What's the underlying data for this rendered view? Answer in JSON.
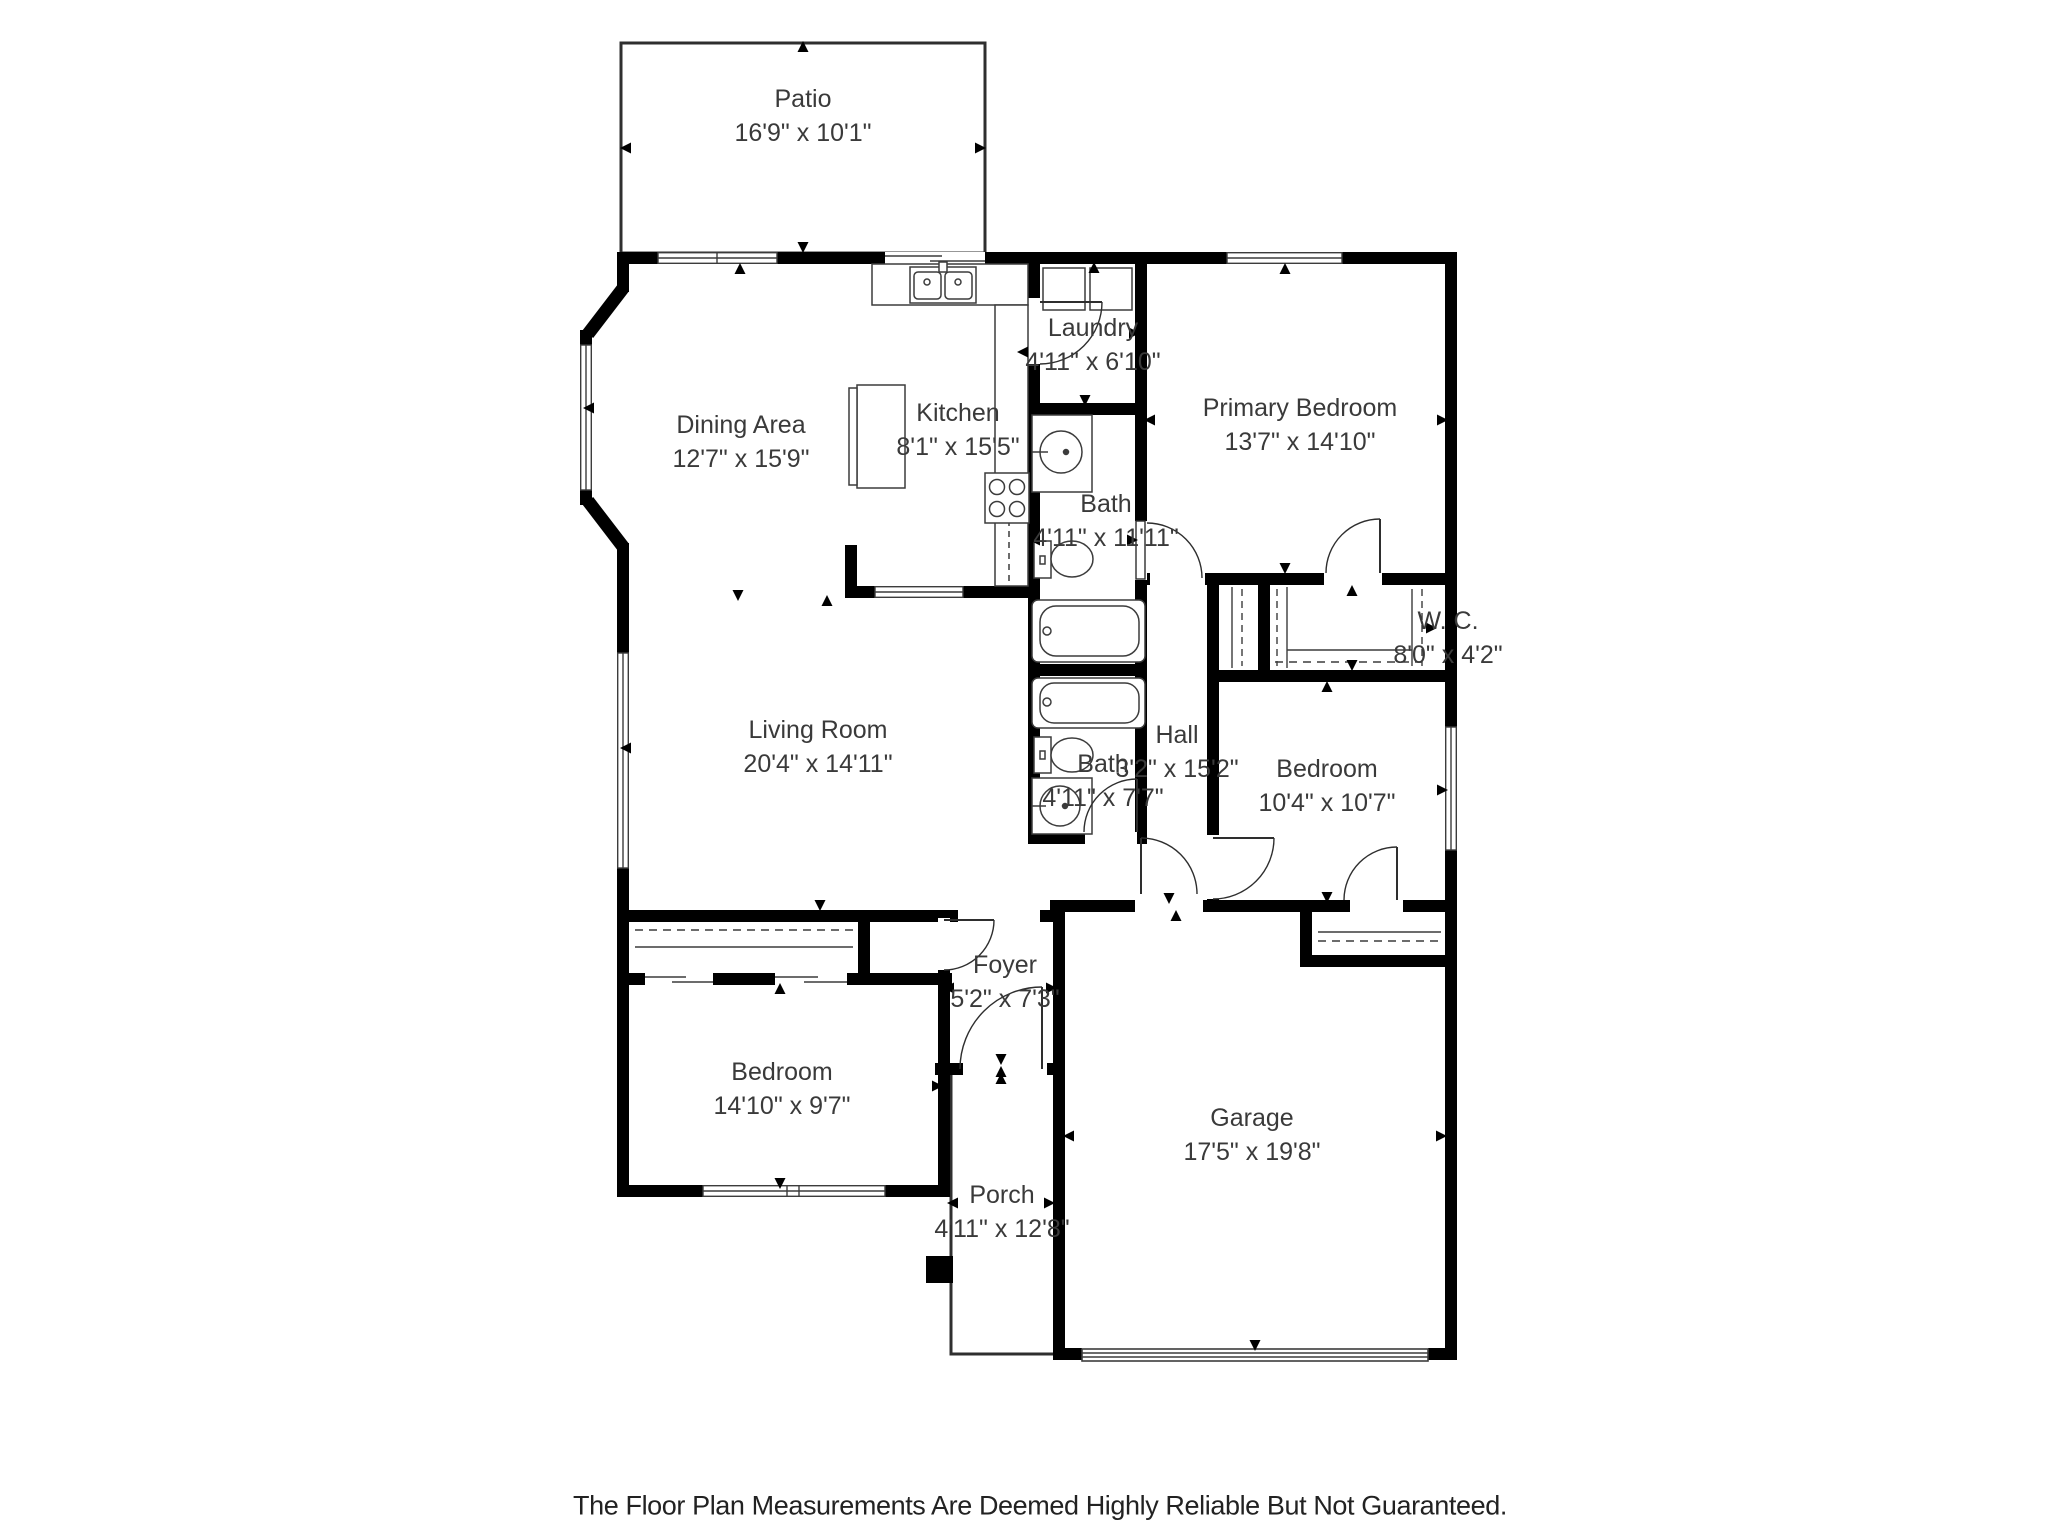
{
  "colors": {
    "wall": "#000000",
    "label_text": "#3a3a3a",
    "thin_line": "#3c3c3c",
    "background": "#ffffff",
    "footer_text": "#222222"
  },
  "rooms": [
    {
      "id": "patio",
      "name": "Patio",
      "dims": "16'9\" x 10'1\""
    },
    {
      "id": "laundry",
      "name": "Laundry",
      "dims": "4'11\" x 6'10\""
    },
    {
      "id": "dining-area",
      "name": "Dining Area",
      "dims": "12'7\" x 15'9\""
    },
    {
      "id": "kitchen",
      "name": "Kitchen",
      "dims": "8'1\" x 15'5\""
    },
    {
      "id": "primary-bedroom",
      "name": "Primary Bedroom",
      "dims": "13'7\" x 14'10\""
    },
    {
      "id": "bath-upper",
      "name": "Bath",
      "dims": "4'11\" x 11'11\""
    },
    {
      "id": "walk-in-closet",
      "name": "W. C.",
      "dims": "8'0\" x 4'2\""
    },
    {
      "id": "living-room",
      "name": "Living Room",
      "dims": "20'4\" x 14'11\""
    },
    {
      "id": "hall",
      "name": "Hall",
      "dims": "3'2\" x 15'2\""
    },
    {
      "id": "bedroom-right",
      "name": "Bedroom",
      "dims": "10'4\" x 10'7\""
    },
    {
      "id": "bath-lower",
      "name": "Bath",
      "dims": "4'11\" x 7'7\""
    },
    {
      "id": "foyer",
      "name": "Foyer",
      "dims": "5'2\" x 7'3\""
    },
    {
      "id": "bedroom-left",
      "name": "Bedroom",
      "dims": "14'10\" x 9'7\""
    },
    {
      "id": "garage",
      "name": "Garage",
      "dims": "17'5\" x 19'8\""
    },
    {
      "id": "porch",
      "name": "Porch",
      "dims": "4'11\" x 12'8\""
    }
  ],
  "footer": {
    "disclaimer": "The Floor Plan Measurements Are Deemed Highly Reliable But Not Guaranteed."
  }
}
